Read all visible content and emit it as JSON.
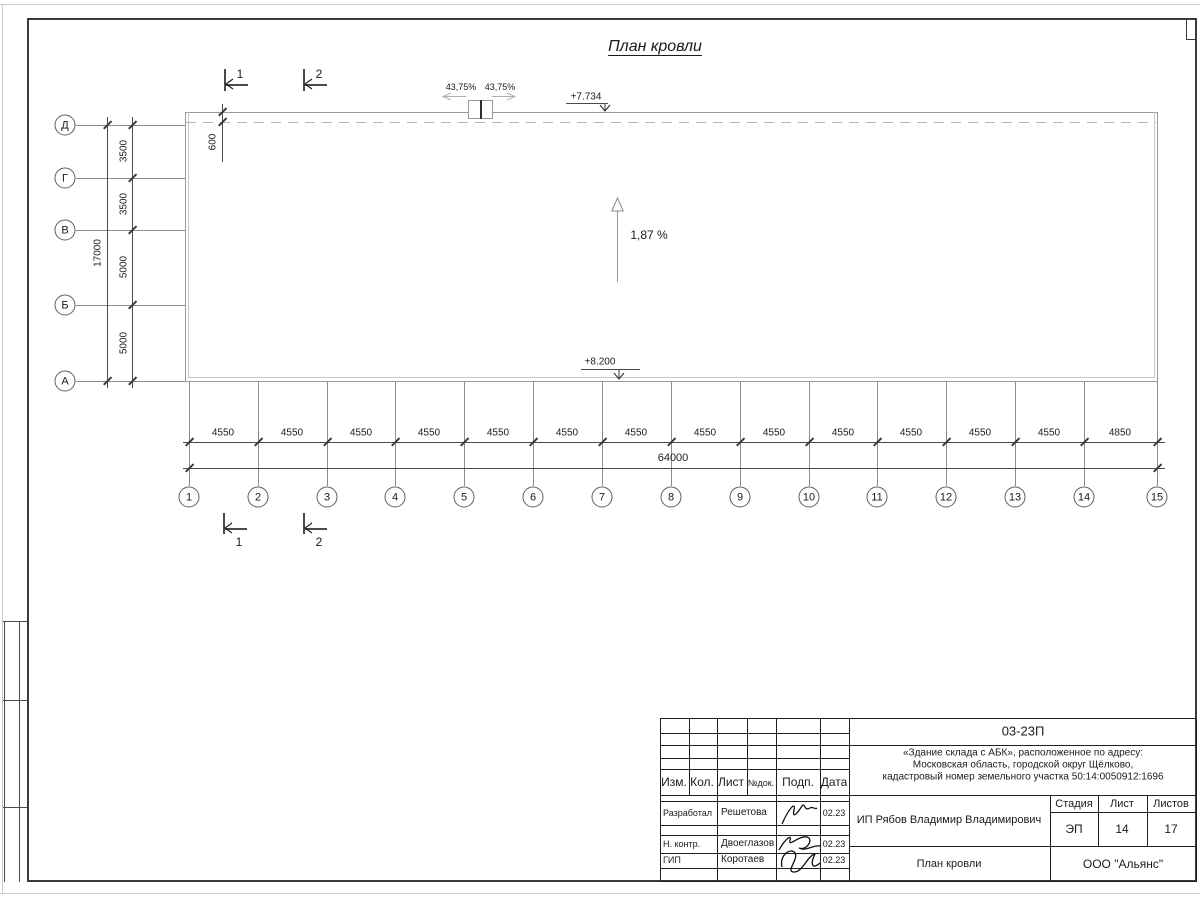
{
  "drawing_title": "План кровли",
  "axes": {
    "rows": [
      "Д",
      "Г",
      "В",
      "Б",
      "А"
    ],
    "cols": [
      "1",
      "2",
      "3",
      "4",
      "5",
      "6",
      "7",
      "8",
      "9",
      "10",
      "11",
      "12",
      "13",
      "14",
      "15"
    ],
    "row_dims": [
      "3500",
      "3500",
      "5000",
      "5000"
    ],
    "row_total": "17000",
    "col_dims": [
      "4550",
      "4550",
      "4550",
      "4550",
      "4550",
      "4550",
      "4550",
      "4550",
      "4550",
      "4550",
      "4550",
      "4550",
      "4550",
      "4850"
    ],
    "col_total": "64000",
    "parapet_dim": "600"
  },
  "annotations": {
    "elev_top": "+7.734",
    "elev_bottom": "+8.200",
    "slope_main": "1,87 %",
    "slope_left": "43,75%",
    "slope_right": "43,75%",
    "section_1": "1",
    "section_2": "2"
  },
  "titleblock": {
    "doc_number": "03-23П",
    "project_lines": [
      "«Здание склада с АБК», расположенное по адресу:",
      "Московская область, городской округ Щёлково,",
      "кадастровый номер земельного участка 50:14:0050912:1696"
    ],
    "col_headers": {
      "izm": "Изм.",
      "kol": "Кол.",
      "list": "Лист",
      "ndok": "№док.",
      "podp": "Подп.",
      "data": "Дата"
    },
    "signers": [
      {
        "role": "Разработал",
        "name": "Решетова",
        "date": "02.23"
      },
      {
        "role": "Н. контр.",
        "name": "Двоеглазов",
        "date": "02.23"
      },
      {
        "role": "ГИП",
        "name": "Коротаев",
        "date": "02.23"
      }
    ],
    "client": "ИП Рябов Владимир Владимирович",
    "stage_label": "Стадия",
    "sheet_label": "Лист",
    "sheets_label": "Листов",
    "stage": "ЭП",
    "sheet_num": "14",
    "sheets_total": "17",
    "drawing_name": "План кровли",
    "company": "ООО \"Альянс\""
  }
}
